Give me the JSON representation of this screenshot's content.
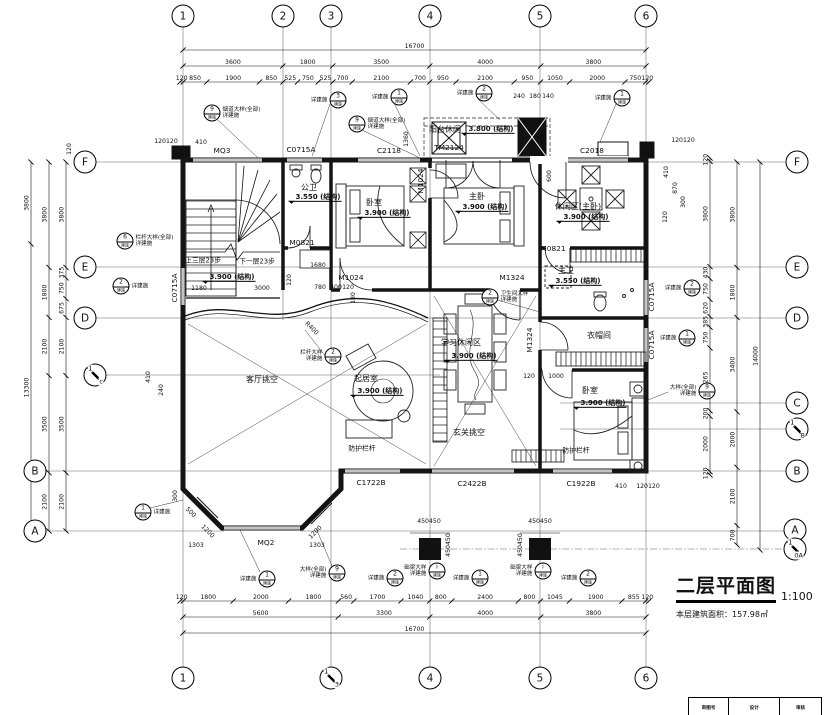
{
  "sheet": {
    "title": "二层平面图",
    "scale": "1:100",
    "area_note": "本层建筑面积：157.98㎡"
  },
  "title_table": {
    "cols": [
      "审图号",
      "设计",
      "审核"
    ]
  },
  "callout_sub": "建施",
  "bubbles": [
    {
      "t": "1",
      "x": 183,
      "y": 16
    },
    {
      "t": "2",
      "x": 283,
      "y": 16
    },
    {
      "t": "3",
      "x": 331,
      "y": 16
    },
    {
      "t": "4",
      "x": 430,
      "y": 16
    },
    {
      "t": "5",
      "x": 540,
      "y": 16
    },
    {
      "t": "6",
      "x": 646,
      "y": 16
    },
    {
      "t": "1",
      "x": 183,
      "y": 678
    },
    {
      "a": "1",
      "b": "3",
      "x": 331,
      "y": 678
    },
    {
      "t": "4",
      "x": 430,
      "y": 678
    },
    {
      "t": "5",
      "x": 540,
      "y": 678
    },
    {
      "t": "6",
      "x": 646,
      "y": 678
    },
    {
      "t": "F",
      "x": 85,
      "y": 162
    },
    {
      "t": "E",
      "x": 85,
      "y": 267
    },
    {
      "t": "D",
      "x": 85,
      "y": 318
    },
    {
      "a": "1",
      "b": "c",
      "x": 95,
      "y": 375
    },
    {
      "t": "B",
      "x": 35,
      "y": 471
    },
    {
      "t": "A",
      "x": 35,
      "y": 531
    },
    {
      "t": "F",
      "x": 797,
      "y": 162
    },
    {
      "t": "E",
      "x": 797,
      "y": 267
    },
    {
      "t": "D",
      "x": 797,
      "y": 318
    },
    {
      "t": "C",
      "x": 797,
      "y": 403
    },
    {
      "a": "1",
      "b": "B",
      "x": 797,
      "y": 429
    },
    {
      "t": "B",
      "x": 797,
      "y": 471
    },
    {
      "t": "A",
      "x": 795,
      "y": 530
    },
    {
      "a": "1",
      "b": "0A",
      "x": 795,
      "y": 549
    }
  ],
  "dim_rows": [
    {
      "o": "h",
      "y": 50,
      "x0": 183,
      "x1": 646,
      "vals": [
        "16700"
      ]
    },
    {
      "o": "h",
      "y": 66,
      "x0": 183,
      "x1": 646,
      "vals": [
        "3600",
        "1800",
        "3500",
        "4000",
        "3800"
      ]
    },
    {
      "o": "h",
      "y": 82,
      "x0": 180,
      "x1": 649,
      "vals": [
        "120",
        "850",
        "1900",
        "850",
        "525",
        "750",
        "525",
        "700",
        "2100",
        "700",
        "950",
        "2100",
        "950",
        "1050",
        "2000",
        "750",
        "120"
      ]
    },
    {
      "o": "h",
      "y": 601,
      "x0": 180,
      "x1": 649,
      "vals": [
        "120",
        "1800",
        "2000",
        "1800",
        "560",
        "1700",
        "1040",
        "800",
        "2400",
        "800",
        "1045",
        "1900",
        "855",
        "120"
      ]
    },
    {
      "o": "h",
      "y": 617,
      "x0": 183,
      "x1": 646,
      "vals": [
        "5600",
        "3300",
        "4000",
        "3800"
      ]
    },
    {
      "o": "h",
      "y": 633,
      "x0": 183,
      "x1": 646,
      "vals": [
        "16700"
      ]
    },
    {
      "o": "v",
      "x": 31,
      "y0": 162,
      "y1": 531,
      "vals": [
        "3800",
        "13300"
      ]
    },
    {
      "o": "v",
      "x": 49,
      "y0": 162,
      "y1": 531,
      "vals": [
        "3800",
        "1800",
        "2100",
        "3500",
        "2100"
      ]
    },
    {
      "o": "v",
      "x": 66,
      "y0": 162,
      "y1": 531,
      "vals": [
        "3800",
        "375",
        "750",
        "675",
        "2100",
        "3500",
        "2100"
      ]
    },
    {
      "o": "v",
      "x": 710,
      "y0": 158,
      "y1": 475,
      "vals": [
        "120",
        "3800",
        "430",
        "750",
        "620",
        "385",
        "750",
        "2265",
        "200",
        "2000",
        "120"
      ]
    },
    {
      "o": "v",
      "x": 737,
      "y0": 162,
      "y1": 545,
      "vals": [
        "3800",
        "1800",
        "3400",
        "2000",
        "2100",
        "700"
      ]
    },
    {
      "o": "v",
      "x": 760,
      "y0": 162,
      "y1": 550,
      "vals": [
        "14000"
      ]
    }
  ],
  "labels": [
    {
      "t": "MQ3",
      "x": 222,
      "y": 151,
      "c": "code"
    },
    {
      "t": "C0715A",
      "x": 301,
      "y": 150,
      "c": "code"
    },
    {
      "t": "C2118",
      "x": 389,
      "y": 151,
      "c": "code"
    },
    {
      "t": "TM2124",
      "x": 449,
      "y": 148,
      "c": "code"
    },
    {
      "t": "C2018",
      "x": 592,
      "y": 151,
      "c": "code"
    },
    {
      "t": "M0821",
      "x": 302,
      "y": 243,
      "c": "code"
    },
    {
      "t": "M1024",
      "x": 351,
      "y": 278,
      "c": "code"
    },
    {
      "t": "M1324",
      "x": 512,
      "y": 278,
      "c": "code"
    },
    {
      "t": "M0821",
      "x": 553,
      "y": 249,
      "c": "code"
    },
    {
      "t": "1680",
      "x": 318,
      "y": 266,
      "c": "dim"
    },
    {
      "t": "C1722B",
      "x": 371,
      "y": 483,
      "c": "code"
    },
    {
      "t": "C2422B",
      "x": 472,
      "y": 484,
      "c": "code"
    },
    {
      "t": "C1922B",
      "x": 581,
      "y": 484,
      "c": "code"
    },
    {
      "t": "MQ2",
      "x": 266,
      "y": 543,
      "c": "code"
    },
    {
      "t": "M1024",
      "x": 421,
      "y": 181,
      "c": "code",
      "r": -90
    },
    {
      "t": "M1324",
      "x": 530,
      "y": 340,
      "c": "code",
      "r": -90
    },
    {
      "t": "C0715A",
      "x": 175,
      "y": 288,
      "c": "code",
      "r": -90
    },
    {
      "t": "C0715A",
      "x": 652,
      "y": 297,
      "c": "code",
      "r": -90
    },
    {
      "t": "C0715A",
      "x": 652,
      "y": 345,
      "c": "code",
      "r": -90
    },
    {
      "t": "公卫",
      "x": 309,
      "y": 188,
      "c": "room"
    },
    {
      "t": "卧室",
      "x": 374,
      "y": 203,
      "c": "room"
    },
    {
      "t": "主卧",
      "x": 477,
      "y": 197,
      "c": "room"
    },
    {
      "t": "休闲区(主卧)",
      "x": 578,
      "y": 207,
      "c": "room"
    },
    {
      "t": "主卫",
      "x": 566,
      "y": 271,
      "c": "room"
    },
    {
      "t": "衣帽间",
      "x": 599,
      "y": 336,
      "c": "room"
    },
    {
      "t": "卧室",
      "x": 590,
      "y": 391,
      "c": "room"
    },
    {
      "t": "起居室",
      "x": 366,
      "y": 379,
      "c": "room"
    },
    {
      "t": "客厅挑空",
      "x": 262,
      "y": 380,
      "c": "room"
    },
    {
      "t": "玄关挑空",
      "x": 469,
      "y": 433,
      "c": "room"
    },
    {
      "t": "学习休闲区",
      "x": 461,
      "y": 343,
      "c": "room"
    },
    {
      "t": "阳台休闲",
      "x": 445,
      "y": 130,
      "c": "room"
    },
    {
      "t": "3.550 (结构)",
      "x": 315,
      "y": 198,
      "c": "elev"
    },
    {
      "t": "3.900 (结构)",
      "x": 384,
      "y": 214,
      "c": "elev"
    },
    {
      "t": "3.900 (结构)",
      "x": 482,
      "y": 208,
      "c": "elev"
    },
    {
      "t": "3.900 (结构)",
      "x": 583,
      "y": 218,
      "c": "elev"
    },
    {
      "t": "3.550 (结构)",
      "x": 575,
      "y": 282,
      "c": "elev"
    },
    {
      "t": "3.900 (结构)",
      "x": 600,
      "y": 404,
      "c": "elev"
    },
    {
      "t": "3.900 (结构)",
      "x": 377,
      "y": 392,
      "c": "elev"
    },
    {
      "t": "3.900 (结构)",
      "x": 471,
      "y": 357,
      "c": "elev"
    },
    {
      "t": "3.800 (结构)",
      "x": 488,
      "y": 130,
      "c": "elev"
    },
    {
      "t": "3.900 (结构)",
      "x": 229,
      "y": 278,
      "c": "elev"
    },
    {
      "t": "防护栏杆",
      "x": 362,
      "y": 449,
      "c": "note"
    },
    {
      "t": "防护栏杆",
      "x": 576,
      "y": 451,
      "c": "note"
    },
    {
      "t": "上三层23步",
      "x": 203,
      "y": 261,
      "c": "note"
    },
    {
      "t": "下一层23步",
      "x": 257,
      "y": 262,
      "c": "note"
    },
    {
      "t": "1180",
      "x": 199,
      "y": 289,
      "c": "dim"
    },
    {
      "t": "3000",
      "x": 262,
      "y": 289,
      "c": "dim"
    },
    {
      "t": "780",
      "x": 320,
      "y": 288,
      "c": "dim"
    },
    {
      "t": "400",
      "x": 336,
      "y": 288,
      "c": "dim"
    },
    {
      "t": "120",
      "x": 348,
      "y": 288,
      "c": "dim"
    },
    {
      "t": "120",
      "x": 290,
      "y": 280,
      "c": "dim",
      "r": -90
    },
    {
      "t": "180",
      "x": 354,
      "y": 298,
      "c": "dim",
      "r": -90
    },
    {
      "t": "120",
      "x": 529,
      "y": 377,
      "c": "dim"
    },
    {
      "t": "1000",
      "x": 556,
      "y": 377,
      "c": "dim"
    },
    {
      "t": "1303",
      "x": 196,
      "y": 546,
      "c": "dim"
    },
    {
      "t": "1303",
      "x": 317,
      "y": 546,
      "c": "dim"
    },
    {
      "t": "450450",
      "x": 429,
      "y": 522,
      "c": "dim"
    },
    {
      "t": "450450",
      "x": 540,
      "y": 522,
      "c": "dim"
    },
    {
      "t": "450450",
      "x": 449,
      "y": 545,
      "c": "dim",
      "r": -90
    },
    {
      "t": "450450",
      "x": 521,
      "y": 545,
      "c": "dim",
      "r": -90
    },
    {
      "t": "120120",
      "x": 166,
      "y": 142,
      "c": "dim"
    },
    {
      "t": "410",
      "x": 201,
      "y": 143,
      "c": "dim"
    },
    {
      "t": "240",
      "x": 519,
      "y": 97,
      "c": "dim"
    },
    {
      "t": "180",
      "x": 535,
      "y": 97,
      "c": "dim"
    },
    {
      "t": "140",
      "x": 548,
      "y": 97,
      "c": "dim"
    },
    {
      "t": "120120",
      "x": 683,
      "y": 141,
      "c": "dim"
    },
    {
      "t": "410",
      "x": 667,
      "y": 172,
      "c": "dim",
      "r": -90
    },
    {
      "t": "870",
      "x": 676,
      "y": 188,
      "c": "dim",
      "r": -90
    },
    {
      "t": "300",
      "x": 684,
      "y": 202,
      "c": "dim",
      "r": -90
    },
    {
      "t": "120",
      "x": 666,
      "y": 217,
      "c": "dim",
      "r": -90
    },
    {
      "t": "410",
      "x": 621,
      "y": 487,
      "c": "dim"
    },
    {
      "t": "120120",
      "x": 648,
      "y": 487,
      "c": "dim"
    },
    {
      "t": "500",
      "x": 190,
      "y": 513,
      "c": "dim",
      "r": 45
    },
    {
      "t": "1200",
      "x": 207,
      "y": 532,
      "c": "dim",
      "r": 45
    },
    {
      "t": "1200",
      "x": 316,
      "y": 533,
      "c": "dim",
      "r": -45
    },
    {
      "t": "300",
      "x": 176,
      "y": 496,
      "c": "dim",
      "r": -90
    },
    {
      "t": "240",
      "x": 162,
      "y": 390,
      "c": "dim",
      "r": -90
    },
    {
      "t": "410",
      "x": 149,
      "y": 377,
      "c": "dim",
      "r": -90
    },
    {
      "t": "120",
      "x": 70,
      "y": 149,
      "c": "dim",
      "r": -90
    },
    {
      "t": "600",
      "x": 550,
      "y": 176,
      "c": "dim",
      "r": -90
    },
    {
      "t": "1360",
      "x": 407,
      "y": 139,
      "c": "dim",
      "r": -90
    },
    {
      "t": "1600",
      "x": 545,
      "y": 139,
      "c": "dim",
      "r": -90
    },
    {
      "t": "R400",
      "x": 311,
      "y": 329,
      "c": "dim",
      "r": 45
    }
  ],
  "callouts": [
    {
      "n": "3",
      "x": 338,
      "y": 100,
      "side": "l",
      "lines": [
        "详建施"
      ]
    },
    {
      "n": "1",
      "x": 399,
      "y": 97,
      "side": "l",
      "lines": [
        "详建施"
      ]
    },
    {
      "n": "2",
      "x": 484,
      "y": 93,
      "side": "l",
      "lines": [
        "详建施"
      ]
    },
    {
      "n": "1",
      "x": 622,
      "y": 98,
      "side": "l",
      "lines": [
        "详建施"
      ]
    },
    {
      "n": "9",
      "x": 212,
      "y": 113,
      "side": "r",
      "lines": [
        "烟道大样(全部)",
        "详建施"
      ]
    },
    {
      "n": "9",
      "x": 357,
      "y": 124,
      "side": "r",
      "lines": [
        "烟道大样(全部)",
        "详建施"
      ]
    },
    {
      "n": "6",
      "x": 125,
      "y": 241,
      "side": "r",
      "lines": [
        "栏杆大样(全部)",
        "详建施"
      ]
    },
    {
      "n": "2",
      "x": 121,
      "y": 286,
      "side": "r",
      "lines": [
        "详建施"
      ]
    },
    {
      "n": "2",
      "x": 333,
      "y": 356,
      "side": "l",
      "lines": [
        "栏杆大样",
        "详建施"
      ]
    },
    {
      "n": "2",
      "x": 490,
      "y": 297,
      "side": "r",
      "lines": [
        "卫生间大样",
        "详建施"
      ]
    },
    {
      "n": "2",
      "x": 692,
      "y": 288,
      "side": "l",
      "lines": [
        "详建施"
      ]
    },
    {
      "n": "1",
      "x": 687,
      "y": 338,
      "side": "l",
      "lines": [
        "详建施"
      ]
    },
    {
      "n": "9",
      "x": 707,
      "y": 391,
      "side": "l",
      "lines": [
        "大样(全部)",
        "详建施"
      ]
    },
    {
      "n": "1",
      "x": 143,
      "y": 512,
      "side": "r",
      "lines": [
        "详建施"
      ]
    },
    {
      "n": "1",
      "x": 267,
      "y": 579,
      "side": "l",
      "lines": [
        "详建施"
      ]
    },
    {
      "n": "9",
      "x": 337,
      "y": 573,
      "side": "l",
      "lines": [
        "大样(全部)",
        "详建施"
      ]
    },
    {
      "n": "2",
      "x": 395,
      "y": 578,
      "side": "l",
      "lines": [
        "详建施"
      ]
    },
    {
      "n": "i",
      "x": 437,
      "y": 571,
      "side": "l",
      "lines": [
        "础梁大样",
        "详建施"
      ]
    },
    {
      "n": "1",
      "x": 480,
      "y": 578,
      "side": "l",
      "lines": [
        "详建施"
      ]
    },
    {
      "n": "i",
      "x": 543,
      "y": 571,
      "side": "l",
      "lines": [
        "础梁大样",
        "详建施"
      ]
    },
    {
      "n": "2",
      "x": 588,
      "y": 578,
      "side": "l",
      "lines": [
        "详建施"
      ]
    }
  ]
}
